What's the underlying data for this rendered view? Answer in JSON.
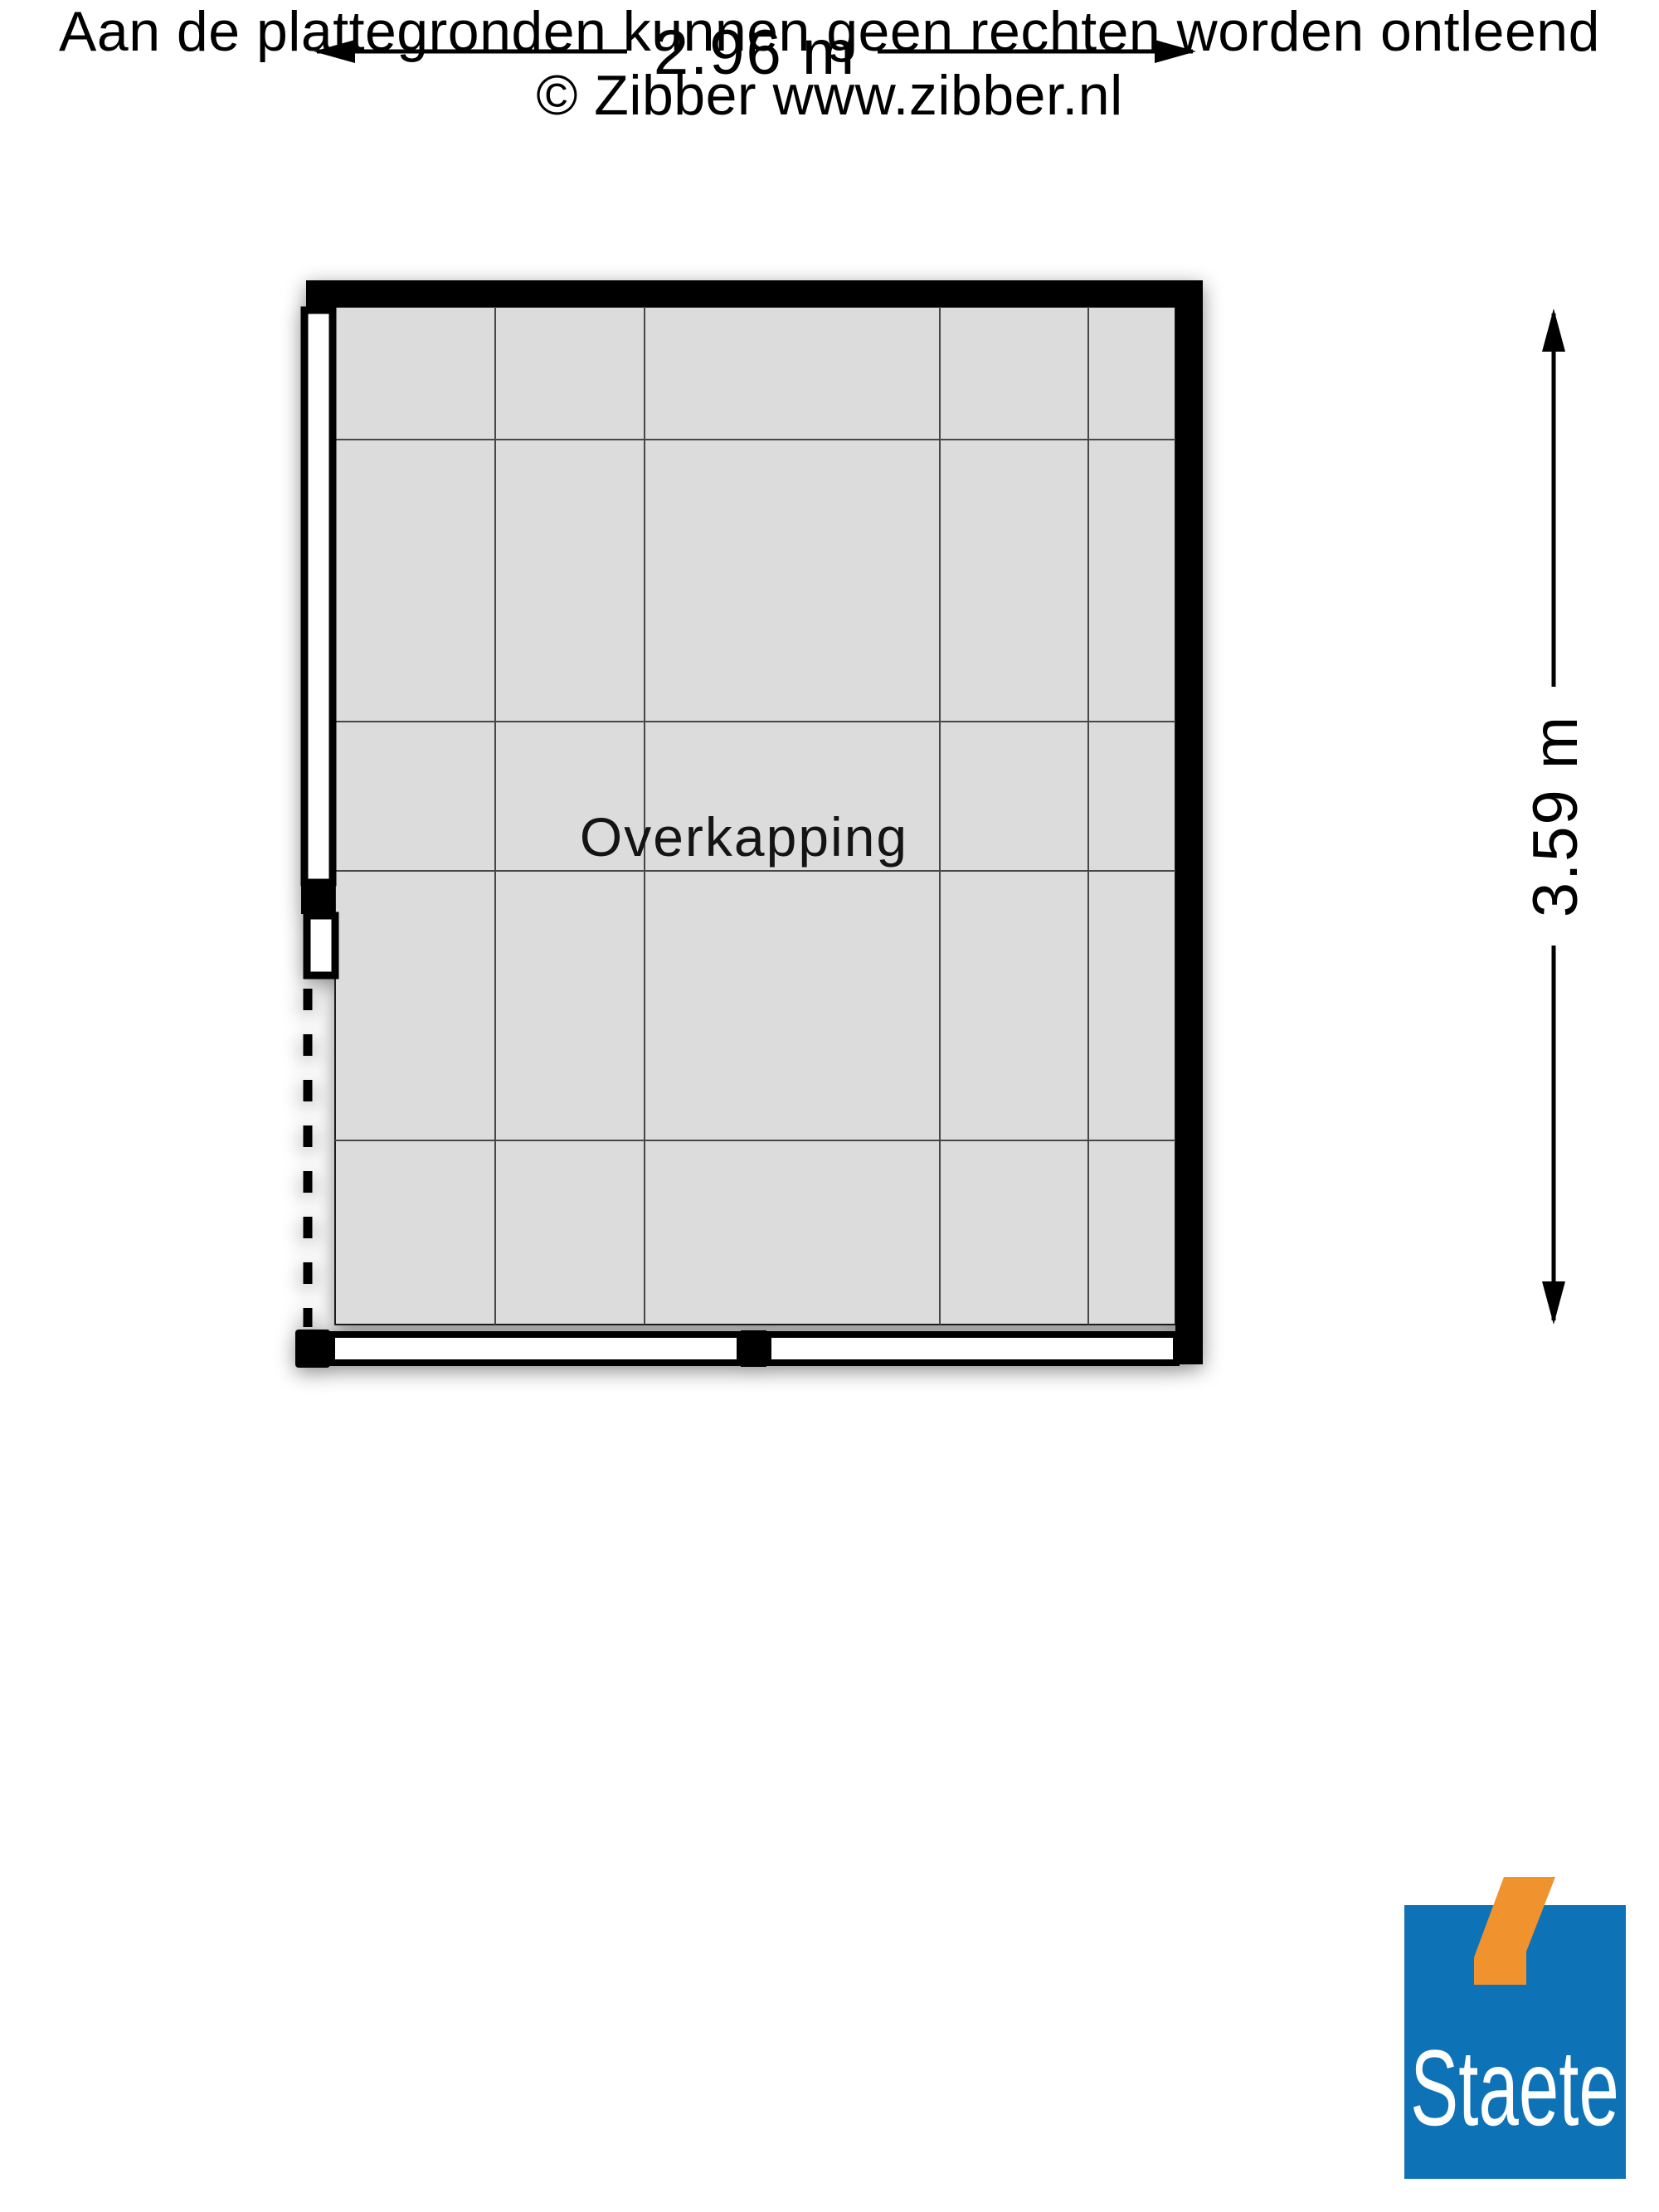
{
  "plan": {
    "room_label": "Overkapping",
    "dimensions": {
      "width_label": "2.96 m",
      "height_label": "3.59 m"
    }
  },
  "footer": {
    "disclaimer_line1": "Aan de plattegronden kunnen geen rechten worden ontleend",
    "disclaimer_line2": "© Zibber www.zibber.nl"
  },
  "logo": {
    "brand": "Staete",
    "blue": "#0e72b7",
    "orange": "#f0922e"
  },
  "colors": {
    "floor": "#dcdcdc",
    "grid": "#474747",
    "wall": "#000000"
  }
}
